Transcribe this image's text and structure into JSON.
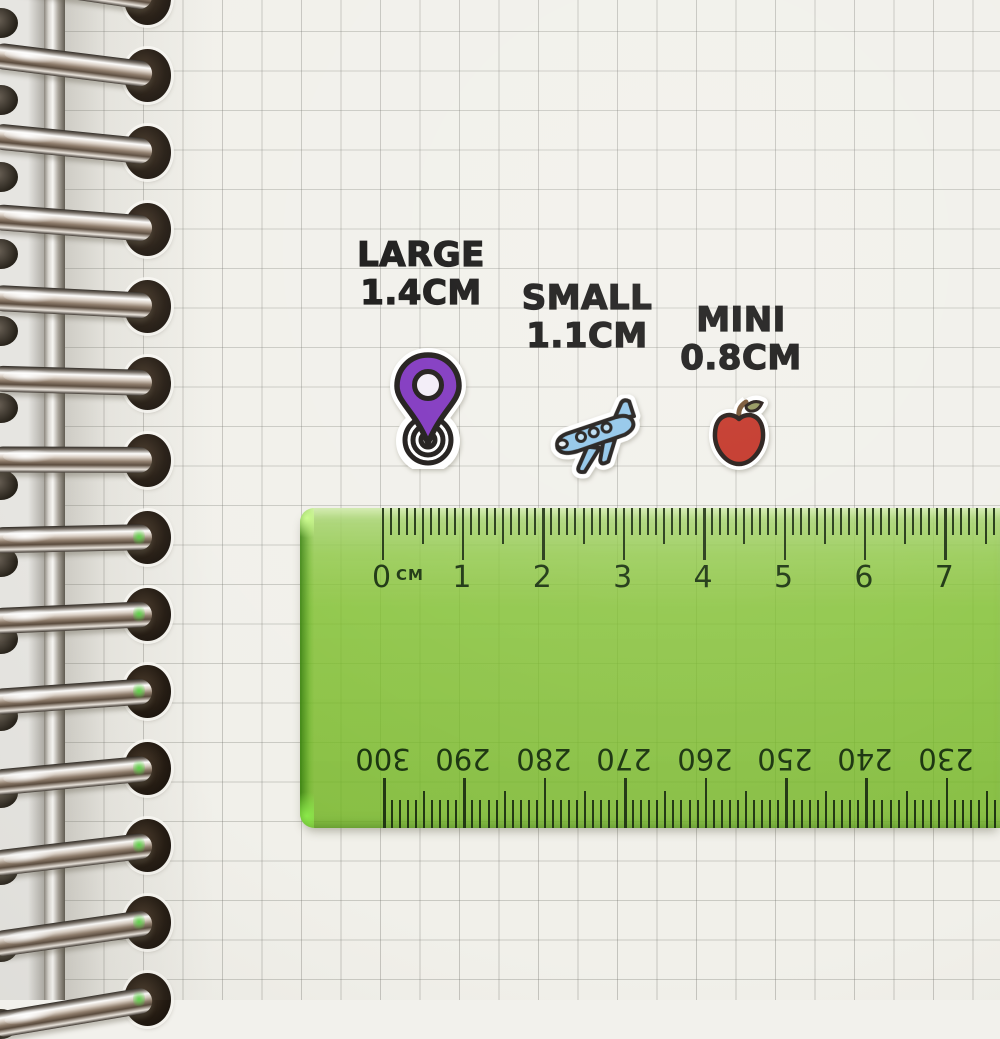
{
  "labels": {
    "large": {
      "title": "LARGE",
      "size": "1.4CM"
    },
    "small": {
      "title": "SMALL",
      "size": "1.1CM"
    },
    "mini": {
      "title": "MINI",
      "size": "0.8CM"
    }
  },
  "stickers": {
    "pin": {
      "name": "location-pin",
      "fill": "#7b2ebd",
      "inner": "#f2ecf7",
      "outline": "#14100e"
    },
    "plane": {
      "name": "airplane",
      "fill": "#8cc3e8",
      "window": "#b9dcf2",
      "outline": "#14100e"
    },
    "apple": {
      "name": "apple",
      "fill": "#c02a1c",
      "stem": "#6f4a27",
      "leaf": "#8e9054",
      "outline": "#190e0a"
    }
  },
  "ruler": {
    "unit_label": "CM",
    "top_scale": [
      "0",
      "1",
      "2",
      "3",
      "4",
      "5",
      "6",
      "7"
    ],
    "bottom_scale": [
      "300",
      "290",
      "280",
      "270",
      "260",
      "250",
      "240",
      "230"
    ],
    "body_color": "#96c84e",
    "tick_color": "#1d330e"
  },
  "colors": {
    "paper": "#f1f0ea",
    "grid_line": "#c9c8c2",
    "label_text": "#0d0c0b"
  }
}
